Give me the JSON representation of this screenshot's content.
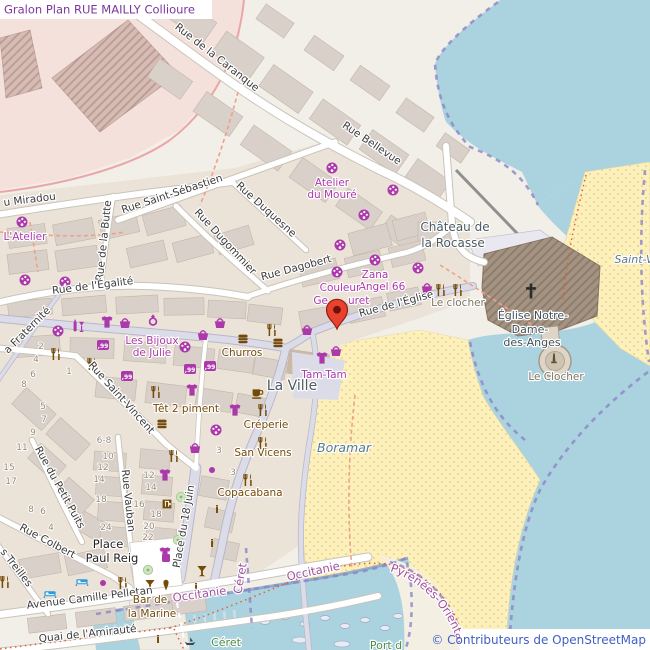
{
  "title": {
    "text": "Gralon Plan RUE MAILLY Collioure"
  },
  "attribution": {
    "text": "© Contributeurs de OpenStreetMap"
  },
  "curved": {
    "pyrenees": "Pyrénées-Orientales"
  },
  "colors": {
    "land": "#f2efe9",
    "water": "#aad3df",
    "beach": "#fdf0ba",
    "building": "#d9d0c9",
    "road": "#ffffff",
    "pedestrian": "#dcdce8",
    "shop_purple": "#ac39ac",
    "food_brown": "#734a08",
    "boundary_purple": "#8d85c6",
    "boundary_red": "#e0603a",
    "place_label": "#4c5a62",
    "water_label": "#5b7a8e",
    "title_purple": "#7d35a0",
    "attribution_blue": "#3f5fc8",
    "marker_red": "#e8412e",
    "admin_label": "#a050a0",
    "green_label": "#4a8b4a",
    "fort_pink": "#f5e1db",
    "church_brown": "#a59382"
  },
  "icon_legend": {
    "palette": "art-shop",
    "tshirt": "clothes-shop",
    "basket": "shop-basket",
    "tag99": "variety-store",
    "ring": "jewelry-shop",
    "wine": "alcohol-shop",
    "fork": "restaurant",
    "burger": "fast-food",
    "cup": "cafe",
    "cocktail": "bar",
    "icecream": "ice-cream",
    "info": "information",
    "door": "shop-entrance",
    "bed": "hotel",
    "tree": "tree",
    "dot": "shop-node",
    "sq": "shop-node",
    "boat": "boat",
    "cross": "church-cross",
    "monu": "monument",
    "marker": "selected-location-pin"
  },
  "labels": [
    {
      "n": "street-label-caranque",
      "text": "Rue de la Caranque",
      "x": 215,
      "y": 60,
      "rot": 38,
      "cls": "st"
    },
    {
      "n": "street-label-bellevue",
      "text": "Rue Bellevue",
      "x": 370,
      "y": 146,
      "rot": 34,
      "cls": "st"
    },
    {
      "n": "street-label-miradou",
      "text": "u Miradou",
      "x": 4,
      "y": 206,
      "rot": -7,
      "cls": "st",
      "anchor": "start"
    },
    {
      "n": "street-label-saint-sebastien",
      "text": "Rue Saint-Sébastien",
      "x": 173,
      "y": 197,
      "rot": -18,
      "cls": "st"
    },
    {
      "n": "street-label-butte",
      "text": "Rue de la Butte",
      "x": 107,
      "y": 241,
      "rot": -84,
      "cls": "st"
    },
    {
      "n": "street-label-dugommier",
      "text": "Rue Dugommier",
      "x": 223,
      "y": 244,
      "rot": 47,
      "cls": "st"
    },
    {
      "n": "street-label-duquesne",
      "text": "Rue Duquesne",
      "x": 264,
      "y": 212,
      "rot": 42,
      "cls": "st"
    },
    {
      "n": "street-label-dagobert",
      "text": "Rue Dagobert",
      "x": 297,
      "y": 271,
      "rot": -15,
      "cls": "st"
    },
    {
      "n": "street-label-egalite",
      "text": "Rue de l'Égalité",
      "x": 93,
      "y": 289,
      "rot": -7,
      "cls": "st"
    },
    {
      "n": "street-label-eglise",
      "text": "Rue de l'Église",
      "x": 397,
      "y": 307,
      "rot": -15,
      "cls": "st"
    },
    {
      "n": "street-label-fraternite",
      "text": "a Fraternité",
      "x": 8,
      "y": 354,
      "rot": -45,
      "cls": "st",
      "anchor": "start"
    },
    {
      "n": "street-label-saint-vincent",
      "text": "Rue Saint-Vincent",
      "x": 119,
      "y": 400,
      "rot": 48,
      "cls": "st"
    },
    {
      "n": "street-label-petit-puits",
      "text": "Rue du Petit Puits",
      "x": 57,
      "y": 489,
      "rot": 61,
      "cls": "st"
    },
    {
      "n": "street-label-vauban",
      "text": "Rue Vauban",
      "x": 125,
      "y": 501,
      "rot": 84,
      "cls": "st"
    },
    {
      "n": "street-label-colbert",
      "text": "Rue Colbert",
      "x": 46,
      "y": 544,
      "rot": 28,
      "cls": "st"
    },
    {
      "n": "street-label-treilles",
      "text": "s Treilles",
      "x": 0,
      "y": 552,
      "rot": 52,
      "cls": "st",
      "anchor": "start"
    },
    {
      "n": "street-label-18-juin",
      "text": "Place du 18 Juin",
      "x": 187,
      "y": 527,
      "rot": -80,
      "cls": "st"
    },
    {
      "n": "street-label-pelletan",
      "text": "Avenue Camille Pelletan",
      "x": 90,
      "y": 601,
      "rot": -7,
      "cls": "st"
    },
    {
      "n": "street-label-quai-amiraute",
      "text": "Quai de l'Amirauté",
      "x": 88,
      "y": 637,
      "rot": -6,
      "cls": "st"
    },
    {
      "n": "poi-label-atelier-moure-1",
      "text": "Atelier",
      "x": 332,
      "y": 186,
      "cls": "poi"
    },
    {
      "n": "poi-label-atelier-moure-2",
      "text": "du Mouré",
      "x": 332,
      "y": 198,
      "cls": "poi"
    },
    {
      "n": "poi-label-latelier",
      "text": "L'Atelier",
      "x": 25,
      "y": 240,
      "cls": "poi"
    },
    {
      "n": "poi-label-zana-1",
      "text": "Zana",
      "x": 375,
      "y": 278,
      "cls": "poi"
    },
    {
      "n": "poi-label-zana-2",
      "text": "Angel 66",
      "x": 382,
      "y": 290,
      "cls": "poi"
    },
    {
      "n": "poi-label-couleur-1",
      "text": "Couleur",
      "x": 340,
      "y": 291,
      "cls": "poi"
    },
    {
      "n": "poi-label-couleur-2a",
      "text": "Ge",
      "x": 328,
      "y": 304,
      "cls": "poi",
      "anchor": "end"
    },
    {
      "n": "poi-label-couleur-2b",
      "text": "uret",
      "x": 348,
      "y": 304,
      "cls": "poi",
      "anchor": "start"
    },
    {
      "n": "poi-label-bijoux-1",
      "text": "Les Bijoux",
      "x": 152,
      "y": 344,
      "cls": "poi"
    },
    {
      "n": "poi-label-bijoux-2",
      "text": "de Julie",
      "x": 152,
      "y": 356,
      "cls": "poi"
    },
    {
      "n": "poi-label-churros",
      "text": "Churros",
      "x": 242,
      "y": 356,
      "cls": "food"
    },
    {
      "n": "poi-label-tam-tam",
      "text": "Tam-Tam",
      "x": 324,
      "y": 378,
      "cls": "poi"
    },
    {
      "n": "poi-label-tet-2-piment",
      "text": "Têt 2 piment",
      "x": 186,
      "y": 412,
      "cls": "food"
    },
    {
      "n": "poi-label-creperie",
      "text": "Créperie",
      "x": 266,
      "y": 428,
      "cls": "food"
    },
    {
      "n": "poi-label-san-vicens",
      "text": "San Vicens",
      "x": 263,
      "y": 456,
      "cls": "food"
    },
    {
      "n": "poi-label-copacabana",
      "text": "Copacabana",
      "x": 250,
      "y": 496,
      "cls": "food"
    },
    {
      "n": "poi-label-bar-marine-1",
      "text": "Bar de",
      "x": 150,
      "y": 603,
      "cls": "food"
    },
    {
      "n": "poi-label-bar-marine-2",
      "text": "la Marine",
      "x": 152,
      "y": 617,
      "cls": "food"
    },
    {
      "n": "poi-label-le-clocher-restaurant",
      "text": "Le clocher",
      "x": 458,
      "y": 306,
      "cls": "mon"
    },
    {
      "n": "poi-label-le-clocher-monument",
      "text": "Le Clocher",
      "x": 556,
      "y": 380,
      "cls": "mon"
    },
    {
      "n": "place-label-la-ville",
      "text": "La Ville",
      "x": 292,
      "y": 390,
      "cls": "place"
    },
    {
      "n": "place-label-chateau-1",
      "text": "Château de",
      "x": 455,
      "y": 231,
      "cls": "place2"
    },
    {
      "n": "place-label-chateau-2",
      "text": "la Rocasse",
      "x": 453,
      "y": 247,
      "cls": "place2"
    },
    {
      "n": "poi-label-eglise-1",
      "text": "Église Notre-",
      "x": 533,
      "y": 319,
      "cls": "church"
    },
    {
      "n": "poi-label-eglise-2",
      "text": "Dame-",
      "x": 530,
      "y": 333,
      "cls": "church"
    },
    {
      "n": "poi-label-eglise-3",
      "text": "des-Anges",
      "x": 532,
      "y": 346,
      "cls": "church"
    },
    {
      "n": "water-label-boramar",
      "text": "Boramar",
      "x": 344,
      "y": 452,
      "cls": "nat"
    },
    {
      "n": "water-label-saint-vincent",
      "text": "Saint-V",
      "x": 634,
      "y": 263,
      "cls": "nat natsm"
    },
    {
      "n": "admin-label-occitanie-1",
      "text": "Occitanie",
      "x": 200,
      "y": 598,
      "rot": -8,
      "cls": "adm"
    },
    {
      "n": "admin-label-occitanie-2",
      "text": "Occitanie",
      "x": 314,
      "y": 575,
      "rot": -12,
      "cls": "adm"
    },
    {
      "n": "admin-label-ceret-purple",
      "text": "Céret",
      "x": 244,
      "y": 579,
      "rot": -80,
      "cls": "adm"
    },
    {
      "n": "green-label-ceret",
      "text": "Céret",
      "x": 226,
      "y": 646,
      "cls": "grn"
    },
    {
      "n": "green-label-port",
      "text": "Port d",
      "x": 386,
      "y": 649,
      "cls": "grn"
    },
    {
      "n": "place-label-paul-reig-1",
      "text": "Place",
      "x": 108,
      "y": 548,
      "cls": "blk"
    },
    {
      "n": "place-label-paul-reig-2",
      "text": "Paul Reig",
      "x": 112,
      "y": 562,
      "cls": "blk"
    }
  ],
  "housenumbers": [
    {
      "text": "9",
      "x": 33,
      "y": 435
    },
    {
      "text": "11",
      "x": 22,
      "y": 450
    },
    {
      "text": "15",
      "x": 9,
      "y": 470
    },
    {
      "text": "17",
      "x": 11,
      "y": 484
    },
    {
      "text": "6-8",
      "x": 104,
      "y": 443
    },
    {
      "text": "10",
      "x": 108,
      "y": 459
    },
    {
      "text": "12",
      "x": 103,
      "y": 470
    },
    {
      "text": "14",
      "x": 99,
      "y": 482
    },
    {
      "text": "18",
      "x": 101,
      "y": 502
    },
    {
      "text": "24",
      "x": 106,
      "y": 530
    },
    {
      "text": "8",
      "x": 31,
      "y": 512
    },
    {
      "text": "6",
      "x": 43,
      "y": 514
    },
    {
      "text": "4",
      "x": 51,
      "y": 530
    },
    {
      "text": "12",
      "x": 149,
      "y": 478
    },
    {
      "text": "14",
      "x": 151,
      "y": 490
    },
    {
      "text": "16",
      "x": 139,
      "y": 507
    },
    {
      "text": "18",
      "x": 156,
      "y": 517
    },
    {
      "text": "20",
      "x": 149,
      "y": 529
    },
    {
      "text": "22",
      "x": 148,
      "y": 540
    },
    {
      "text": "2",
      "x": 41,
      "y": 349
    },
    {
      "text": "4",
      "x": 36,
      "y": 362
    },
    {
      "text": "6",
      "x": 33,
      "y": 377
    },
    {
      "text": "8",
      "x": 24,
      "y": 387
    },
    {
      "text": "5",
      "x": 43,
      "y": 409
    },
    {
      "text": "7",
      "x": 44,
      "y": 422
    },
    {
      "text": "1",
      "x": 69,
      "y": 374
    },
    {
      "text": "3",
      "x": 219,
      "y": 453
    },
    {
      "text": "3",
      "x": 233,
      "y": 475
    }
  ],
  "icons": [
    {
      "t": "palette",
      "x": 332,
      "y": 168
    },
    {
      "t": "palette",
      "x": 393,
      "y": 190
    },
    {
      "t": "palette",
      "x": 364,
      "y": 215
    },
    {
      "t": "palette",
      "x": 340,
      "y": 245
    },
    {
      "t": "palette",
      "x": 375,
      "y": 260
    },
    {
      "t": "palette",
      "x": 337,
      "y": 272
    },
    {
      "t": "palette",
      "x": 418,
      "y": 268
    },
    {
      "t": "palette",
      "x": 22,
      "y": 222
    },
    {
      "t": "palette",
      "x": 25,
      "y": 280
    },
    {
      "t": "palette",
      "x": 65,
      "y": 282
    },
    {
      "t": "palette",
      "x": 58,
      "y": 331
    },
    {
      "t": "palette",
      "x": 185,
      "y": 347
    },
    {
      "t": "palette",
      "x": 216,
      "y": 430
    },
    {
      "t": "tshirt",
      "x": 107,
      "y": 322
    },
    {
      "t": "tshirt",
      "x": 192,
      "y": 390
    },
    {
      "t": "tshirt",
      "x": 235,
      "y": 410
    },
    {
      "t": "tshirt",
      "x": 322,
      "y": 358
    },
    {
      "t": "tshirt",
      "x": 165,
      "y": 475
    },
    {
      "t": "tshirt",
      "x": 165,
      "y": 553
    },
    {
      "t": "basket",
      "x": 125,
      "y": 323
    },
    {
      "t": "basket",
      "x": 220,
      "y": 323
    },
    {
      "t": "basket",
      "x": 203,
      "y": 335
    },
    {
      "t": "basket",
      "x": 307,
      "y": 330
    },
    {
      "t": "basket",
      "x": 336,
      "y": 351
    },
    {
      "t": "basket",
      "x": 427,
      "y": 288
    },
    {
      "t": "basket",
      "x": 195,
      "y": 448
    },
    {
      "t": "tag99",
      "x": 103,
      "y": 345
    },
    {
      "t": "tag99",
      "x": 127,
      "y": 376
    },
    {
      "t": "tag99",
      "x": 190,
      "y": 369
    },
    {
      "t": "tag99",
      "x": 210,
      "y": 366
    },
    {
      "t": "ring",
      "x": 153,
      "y": 320
    },
    {
      "t": "wine",
      "x": 78,
      "y": 326
    },
    {
      "t": "fork",
      "x": 56,
      "y": 354
    },
    {
      "t": "fork",
      "x": 92,
      "y": 364
    },
    {
      "t": "fork",
      "x": 272,
      "y": 330
    },
    {
      "t": "fork",
      "x": 156,
      "y": 392
    },
    {
      "t": "fork",
      "x": 263,
      "y": 410
    },
    {
      "t": "fork",
      "x": 263,
      "y": 443
    },
    {
      "t": "fork",
      "x": 248,
      "y": 480
    },
    {
      "t": "fork",
      "x": 174,
      "y": 456
    },
    {
      "t": "fork",
      "x": 123,
      "y": 583
    },
    {
      "t": "fork",
      "x": 5,
      "y": 582
    },
    {
      "t": "fork",
      "x": 441,
      "y": 290
    },
    {
      "t": "fork",
      "x": 458,
      "y": 290
    },
    {
      "t": "burger",
      "x": 243,
      "y": 339
    },
    {
      "t": "burger",
      "x": 278,
      "y": 343
    },
    {
      "t": "burger",
      "x": 162,
      "y": 424
    },
    {
      "t": "cup",
      "x": 257,
      "y": 393
    },
    {
      "t": "cocktail",
      "x": 150,
      "y": 585
    },
    {
      "t": "cocktail",
      "x": 202,
      "y": 571
    },
    {
      "t": "icecream",
      "x": 166,
      "y": 585
    },
    {
      "t": "info",
      "x": 217,
      "y": 509
    },
    {
      "t": "info",
      "x": 212,
      "y": 543
    },
    {
      "t": "info",
      "x": 196,
      "y": 587
    },
    {
      "t": "info",
      "x": 158,
      "y": 639
    },
    {
      "t": "door",
      "x": 167,
      "y": 504
    },
    {
      "t": "bed",
      "x": 50,
      "y": 594
    },
    {
      "t": "bed",
      "x": 82,
      "y": 582
    },
    {
      "t": "tree",
      "x": 181,
      "y": 497
    },
    {
      "t": "tree",
      "x": 178,
      "y": 540
    },
    {
      "t": "tree",
      "x": 148,
      "y": 570
    },
    {
      "t": "dot",
      "x": 103,
      "y": 583
    },
    {
      "t": "dot",
      "x": 212,
      "y": 470
    },
    {
      "t": "sq",
      "x": 166,
      "y": 558
    },
    {
      "t": "boat",
      "x": 190,
      "y": 642
    }
  ]
}
